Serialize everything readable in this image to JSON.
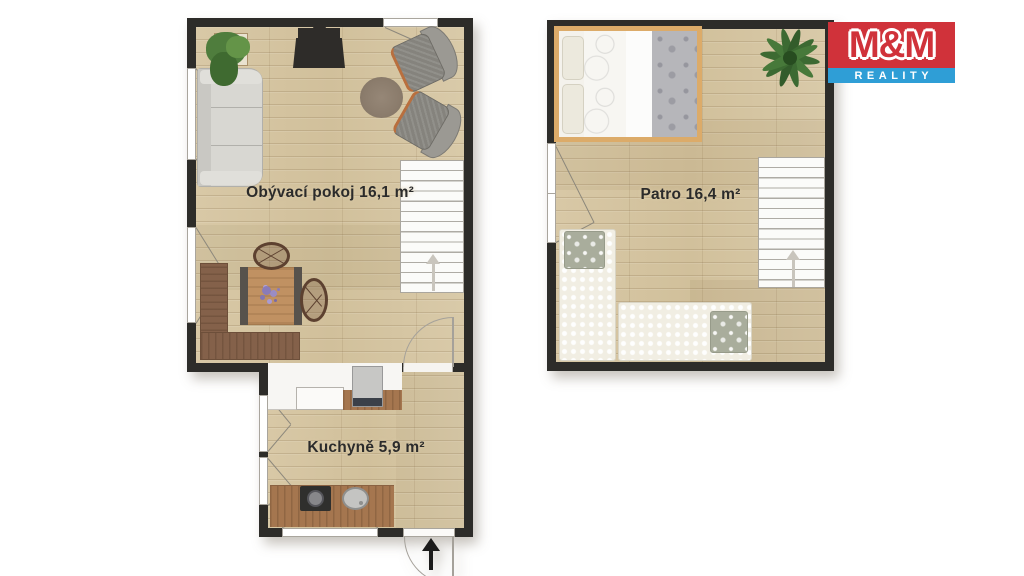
{
  "page": {
    "type": "real-estate-floor-plan",
    "background": "#ffffff"
  },
  "logo": {
    "top": "M&M",
    "bottom": "REALITY",
    "colors": {
      "red": "#d0323a",
      "blue": "#2f9ed6",
      "text": "#ffffff"
    }
  },
  "rooms": [
    {
      "id": "obyvaci-pokoj",
      "label": "Obývací pokoj 16,1 m²"
    },
    {
      "id": "kuchyne",
      "label": "Kuchyně 5,9 m²"
    },
    {
      "id": "patro",
      "label": "Patro 16,4 m²"
    }
  ],
  "palette": {
    "wall": "#2d2c29",
    "floor": "#d6c6a2",
    "counter_wood": "#a5764f",
    "bench_wood": "#84614a",
    "armchair_trim": "#b96f3e",
    "bed_frame": "#dcab69",
    "stair_arrow": "#c9c5bd",
    "entrance_arrow": "#1b1b1b"
  },
  "furniture": [
    "sofa",
    "wood-stove",
    "potted-plant",
    "armchair",
    "armchair",
    "round-rug",
    "dining-table",
    "wicker-chair",
    "wicker-chair",
    "corner-bench",
    "staircase",
    "kitchen-counter",
    "refrigerator",
    "cooktop",
    "sink",
    "double-bed",
    "single-bed",
    "single-bed",
    "plant",
    "staircase",
    "entrance-door",
    "interior-door",
    "windows"
  ]
}
